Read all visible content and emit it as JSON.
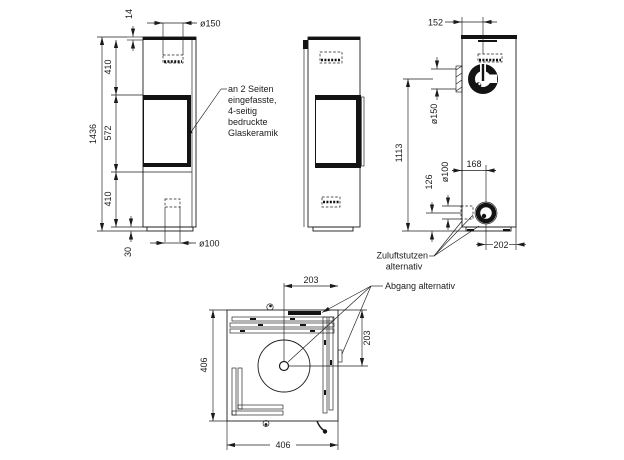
{
  "views": {
    "front": {
      "flue_diameter": "ø150",
      "top_plate": "14",
      "upper_section": "410",
      "glass_height": "572",
      "lower_section": "410",
      "total_height": "1436",
      "base_height": "30",
      "air_diameter": "ø100"
    },
    "back": {
      "flue_offset": "152",
      "flue_diameter": "ø150",
      "flue_center_height": "1113",
      "air_center_height": "126",
      "air_diameter": "ø100",
      "air_offset": "168",
      "air_right_offset": "202"
    },
    "top": {
      "half_width": "203",
      "half_depth": "203",
      "depth": "406",
      "width": "406"
    }
  },
  "annotations": {
    "glass_note_lines": [
      "an 2 Seiten",
      "eingefasste,",
      "4-seitig",
      "bedruckte",
      "Glaskeramik"
    ],
    "air_inlet_note_lines": [
      "Zuluftstutzen",
      "alternativ"
    ],
    "flue_alt_note": "Abgang alternativ"
  },
  "colors": {
    "line": "#1b1b1b",
    "background": "#ffffff"
  }
}
